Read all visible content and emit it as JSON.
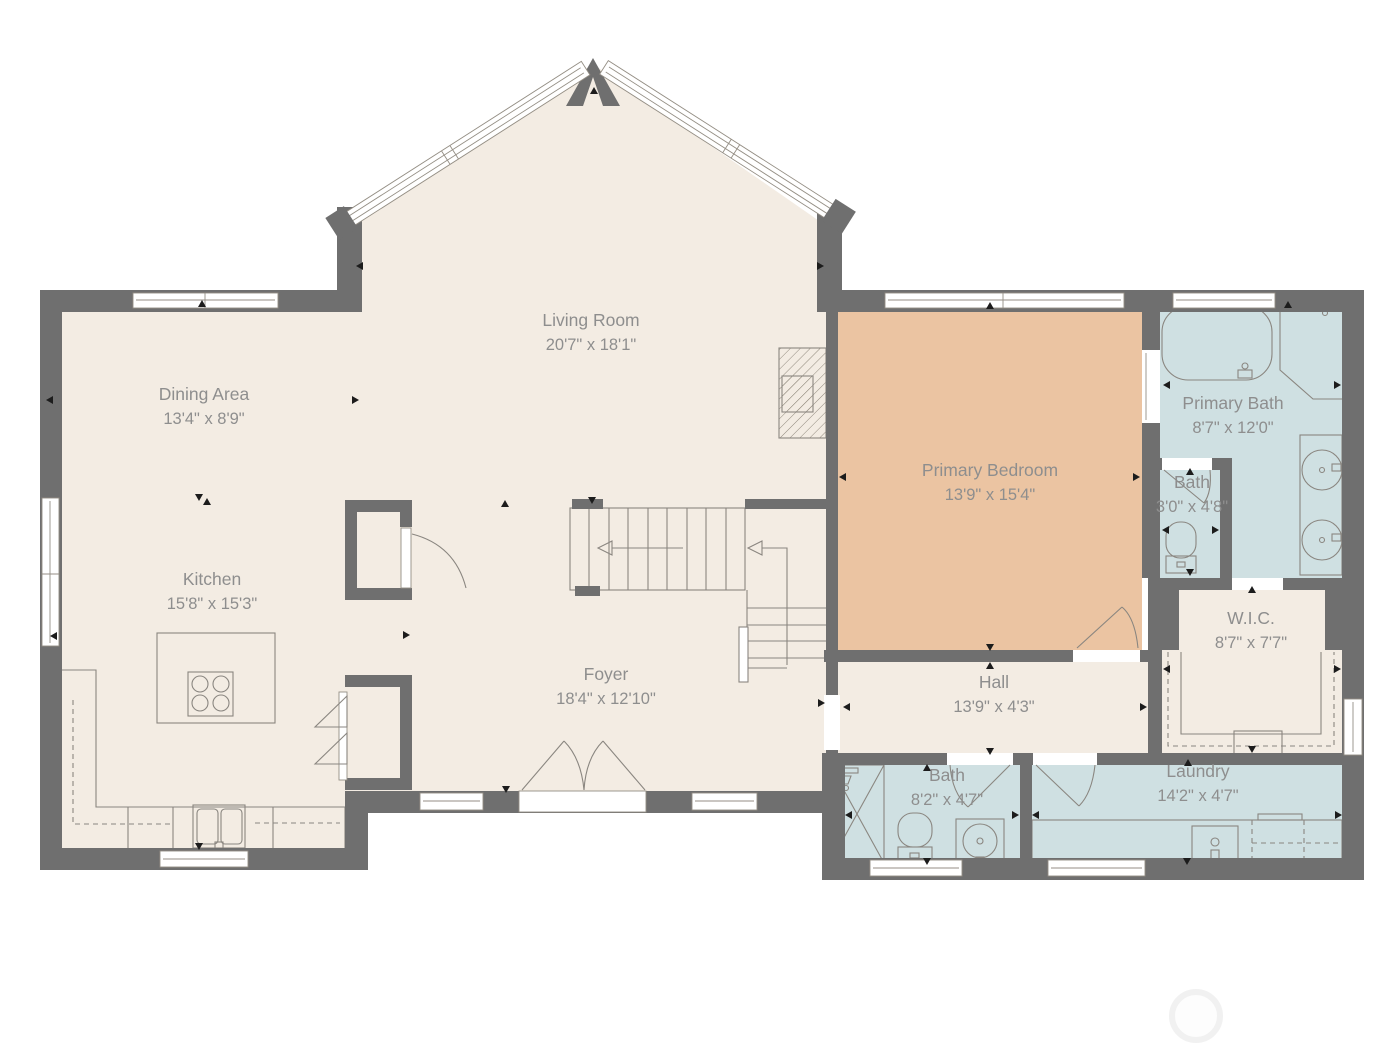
{
  "plan_colors": {
    "floor": "#f3ece3",
    "bedroom_floor": "#ebc4a2",
    "wet_room_floor": "#cfe0e2",
    "wall": "#6f6f6f",
    "label_text": "#8e8e8e",
    "fixture_line": "#8a8680"
  },
  "rooms": [
    {
      "name": "Living Room",
      "dims": "20'7\" x 18'1\""
    },
    {
      "name": "Dining Area",
      "dims": "13'4\" x 8'9\""
    },
    {
      "name": "Kitchen",
      "dims": "15'8\" x 15'3\""
    },
    {
      "name": "Foyer",
      "dims": "18'4\" x 12'10\""
    },
    {
      "name": "Primary Bedroom",
      "dims": "13'9\" x 15'4\""
    },
    {
      "name": "Primary Bath",
      "dims": "8'7\" x 12'0\""
    },
    {
      "name": "Bath",
      "dims": "3'0\" x 4'8\""
    },
    {
      "name": "W.I.C.",
      "dims": "8'7\" x 7'7\""
    },
    {
      "name": "Hall",
      "dims": "13'9\" x 4'3\""
    },
    {
      "name": "Bath",
      "dims": "8'2\" x 4'7\""
    },
    {
      "name": "Laundry",
      "dims": "14'2\" x 4'7\""
    }
  ]
}
